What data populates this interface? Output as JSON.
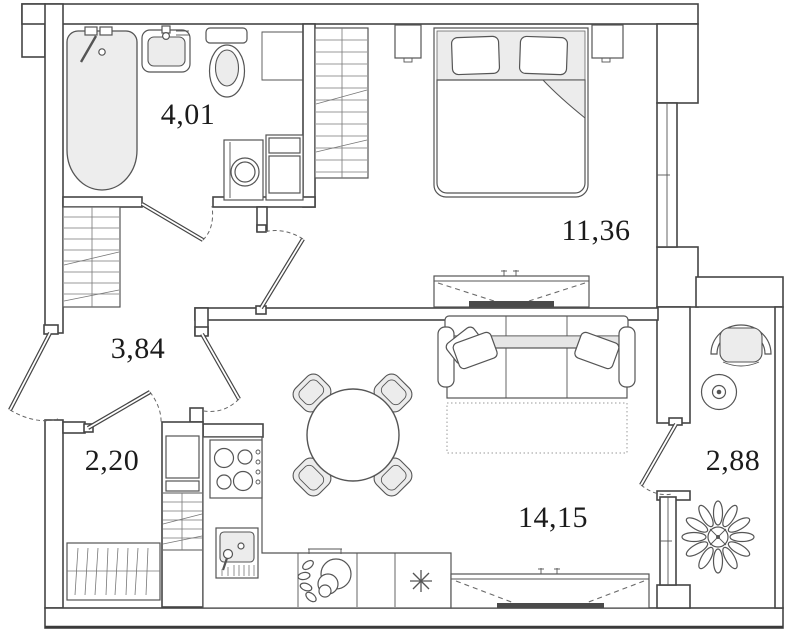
{
  "floorplan": {
    "type": "apartment-floor-plan",
    "colors": {
      "wall_line": "#454545",
      "furniture_line": "#555555",
      "light_fill": "#ececec",
      "tv_bar": "#4a4a4a",
      "label_text": "#1b1b1b",
      "background": "#ffffff"
    },
    "rooms": [
      {
        "id": "bathroom",
        "area": "4,01"
      },
      {
        "id": "hallway",
        "area": "3,84"
      },
      {
        "id": "storage",
        "area": "2,20"
      },
      {
        "id": "bedroom",
        "area": "11,36"
      },
      {
        "id": "living-kitchen",
        "area": "14,15"
      },
      {
        "id": "balcony",
        "area": "2,88"
      }
    ],
    "furniture_icons": [
      "bathtub-icon",
      "wash-basin-icon",
      "toilet-icon",
      "washing-machine-icon",
      "bathroom-cabinet-icon",
      "wardrobe-hatch-icon",
      "closet-hatch-icon",
      "shelf-hatch-icon",
      "double-bed-icon",
      "pillow-icon",
      "nightstand-icon",
      "tv-stand-icon",
      "sofa-icon",
      "rug-icon",
      "round-dining-table-icon",
      "chair-icon",
      "fridge-column-icon",
      "stove-icon",
      "kitchen-sink-icon",
      "fruit-bowl-icon",
      "dishwasher-asterisk-icon",
      "armchair-icon",
      "side-table-icon",
      "plant-icon",
      "window-icon",
      "door-leaf-icon",
      "door-swing-arc-icon"
    ]
  }
}
